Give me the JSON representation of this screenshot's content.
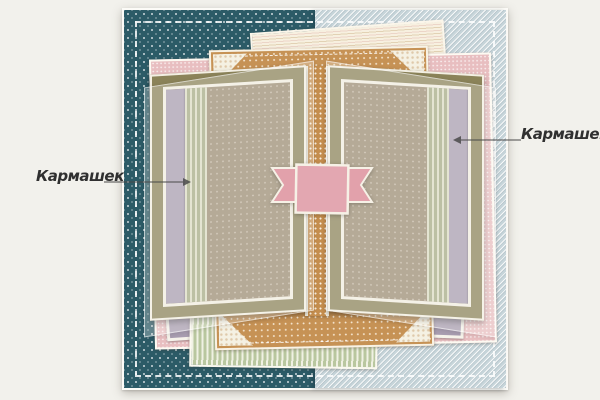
{
  "annotations": {
    "left_pocket": {
      "text": "Кармашек",
      "points_to": "left-panel-pocket-strip"
    },
    "right_pocket": {
      "text": "Кармашек",
      "points_to": "right-panel-pocket-strip"
    }
  },
  "icons": {
    "left_arrow": "arrow-right-icon",
    "right_arrow": "arrow-left-icon",
    "photo_corners": "lace-photo-corner-icon",
    "banner": "ribbon-banner-icon"
  },
  "palette": {
    "page_background": "#f2f1ec",
    "teal_polkadot_paper": "#2c5b67",
    "blue_hatched_paper": "#c7d5da",
    "cream_striped_paper": "#f7f0e0",
    "pink_polkadot_paper": "#e8bec0",
    "green_striped_paper": "#b9c79f",
    "orange_polkadot_paper": "#c69255",
    "olive_panel": "#8b8359",
    "brown_dotted_interior": "#9c8c73",
    "lavender_pocket": "#a89db0",
    "banner_pink": "#e3a7b1",
    "stitching": "#ffffff",
    "paper_edge": "#f3efe3",
    "label_text": "#303030"
  },
  "layers": [
    "canvas-left-teal-half",
    "canvas-right-blue-half",
    "canvas-stitch-border",
    "cream-striped-sheet",
    "pink-polkadot-sheet",
    "lavender-card-bottom-left",
    "lavender-card-bottom-right",
    "green-striped-sheet",
    "orange-polkadot-sheet-with-lace-corners",
    "spine-ribbon",
    "left-book-panel",
    "right-book-panel",
    "left-vellum-overlay",
    "right-vellum-overlay",
    "pink-banner"
  ]
}
